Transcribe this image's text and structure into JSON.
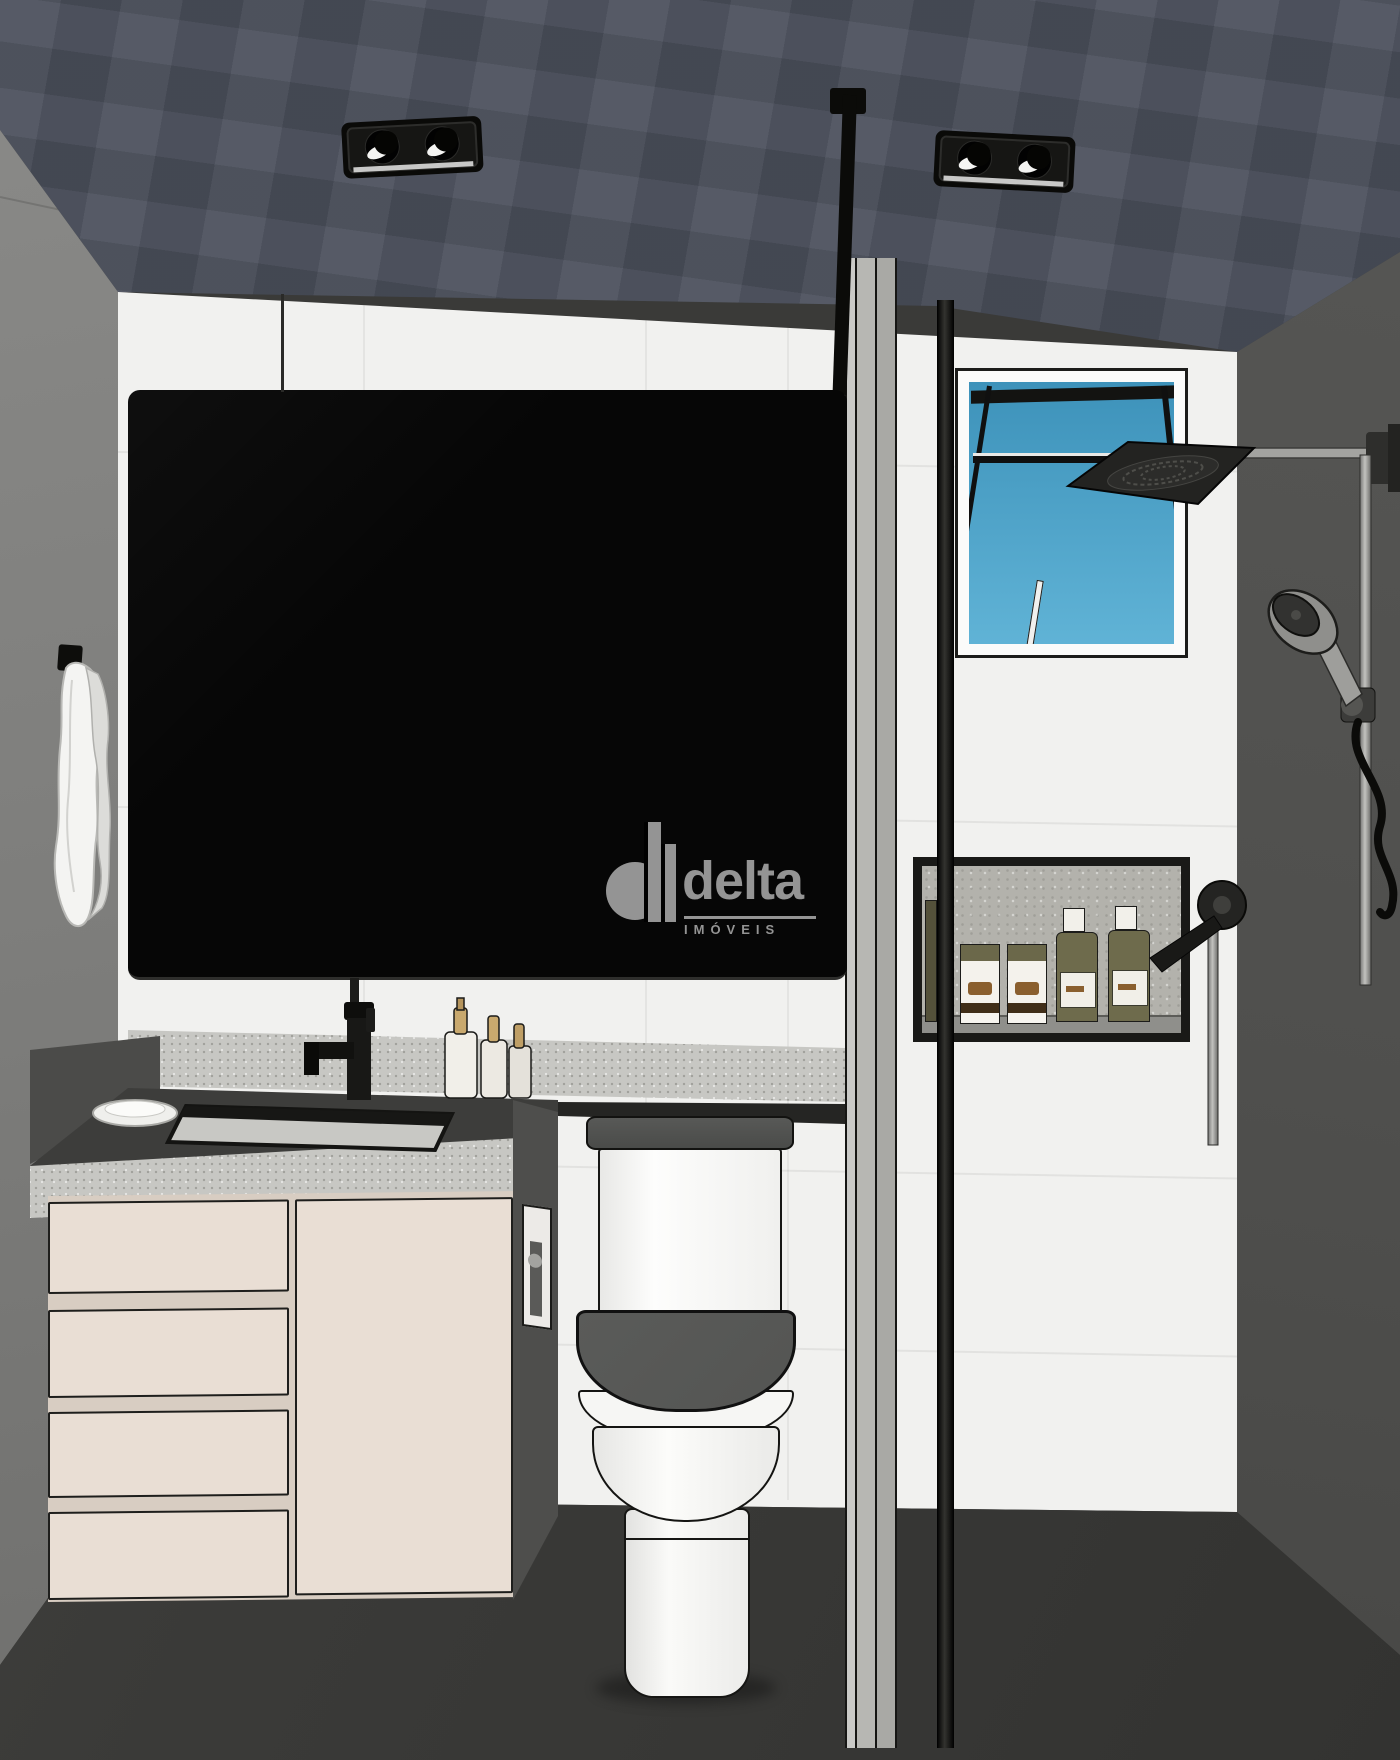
{
  "scene": {
    "type": "interior-3d-render",
    "subject": "bathroom with vanity, mirror, toilet, open window and glass shower"
  },
  "watermark": {
    "brand": "delta",
    "tagline": "IMÓVEIS"
  },
  "palette": {
    "ceiling": "#4a4f5b",
    "wall-left": "#7e7e7c",
    "wall-right": "#4f4f4d",
    "wall-back": "#f1f1ef",
    "floor": "#3a3a38",
    "mirror": "#060606",
    "sky-top": "#3d92ba",
    "sky-bottom": "#60b3d6",
    "cabinet": "#e9ded4",
    "cabinet-body": "#d8cdc2",
    "granite": "#c7c7c3",
    "counter-top": "#3d3d3b",
    "fixture-black": "#141412",
    "metal-gray": "#a6a6a3",
    "olive": "#6e6b4c",
    "porcelain": "#f6f6f4",
    "toilet-seat": "#545553",
    "towel": "#f4f4f2",
    "watermark-gray": "#9d9d9d"
  }
}
